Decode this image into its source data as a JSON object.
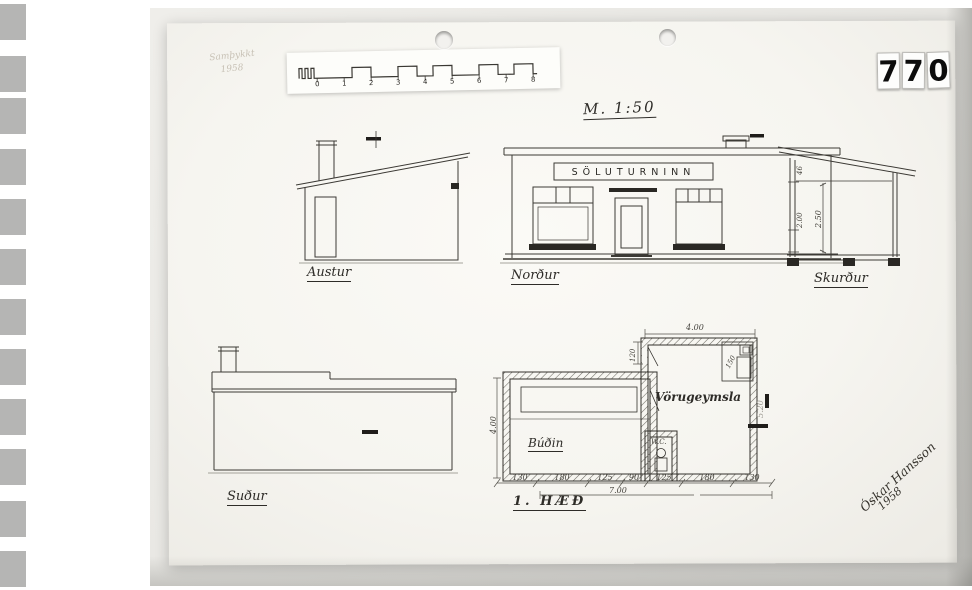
{
  "page": {
    "archive_digits": [
      "7",
      "7",
      "0"
    ],
    "scale_title": "M. 1:50",
    "stamp_line1": "Samþykkt",
    "stamp_line2": "1958"
  },
  "scale_bar": {
    "ticks": [
      "0",
      "1",
      "2",
      "3",
      "4",
      "5",
      "6",
      "7",
      "8"
    ]
  },
  "drawings": {
    "north": {
      "label": "Norður",
      "sign": "SÖLUTURNINN"
    },
    "east": {
      "label": "Austur"
    },
    "section": {
      "label": "Skurður",
      "dims": [
        "46",
        "2.00",
        "2.50"
      ]
    },
    "south": {
      "label": "Suður"
    },
    "plan": {
      "label": "1. HÆÐ",
      "rooms": {
        "storage": "Vörugeymsla",
        "shop": "Búðin",
        "wc": "W.C."
      },
      "dims": {
        "top": "4.00",
        "left": "4.00",
        "right": "5.20",
        "small_top": "120",
        "corner": "150",
        "total": "7.00",
        "chain": [
          "130",
          "180",
          "125",
          "90",
          "125",
          "180",
          "130"
        ]
      }
    }
  },
  "signature": {
    "name": "Óskar Hansson",
    "year": "1958"
  }
}
